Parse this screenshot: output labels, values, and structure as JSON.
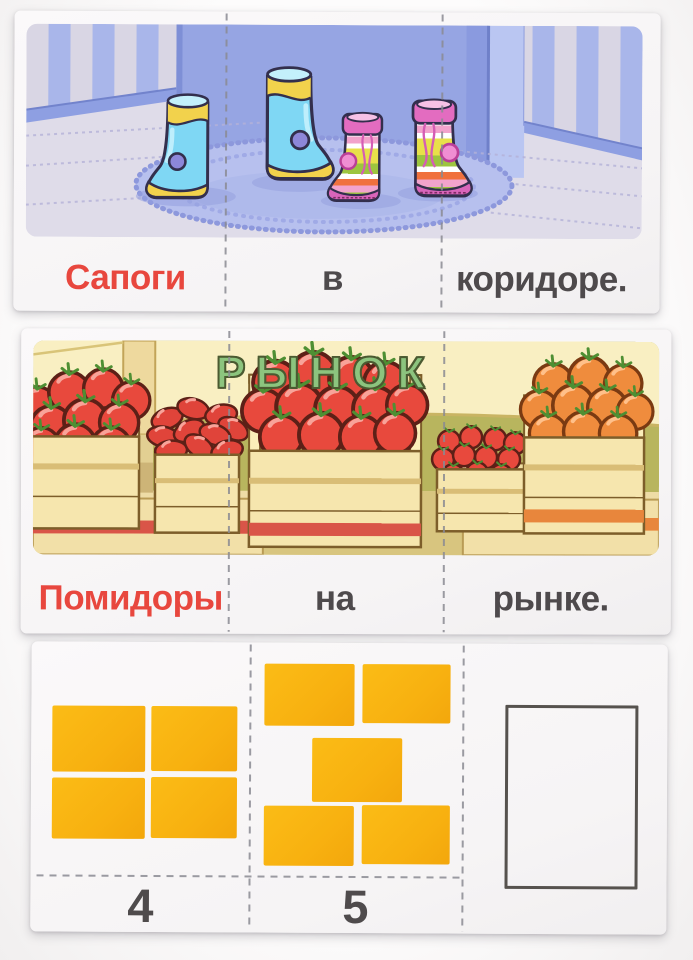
{
  "card_boots": {
    "words": [
      "Сапоги",
      "в",
      "коридоре."
    ]
  },
  "card_market": {
    "sign_text": "РЫНОК",
    "words": [
      "Помидоры",
      "на",
      "рынке."
    ]
  },
  "card_numbers": {
    "sections": [
      {
        "label": "4",
        "count": 4
      },
      {
        "label": "5",
        "count": 5
      },
      {
        "label": "",
        "count": 0
      }
    ]
  },
  "colors": {
    "accent_red_text": "#e8473e",
    "gray_text": "#4e4a4c",
    "tile_yellow": "#f8b110",
    "sign_green": "#8cc47e",
    "tomato_red": "#e8493d",
    "tomato_orange": "#ef8c3d",
    "boot_blue": "#7fd7f4",
    "boot_yellow": "#f2d24c",
    "boot_pink": "#e36cc0",
    "rug_blue": "#b7c0ee",
    "awning_cream": "#f9efc2",
    "market_wall_olive": "#b8b55e",
    "crate_tan": "#f6e6ae"
  }
}
